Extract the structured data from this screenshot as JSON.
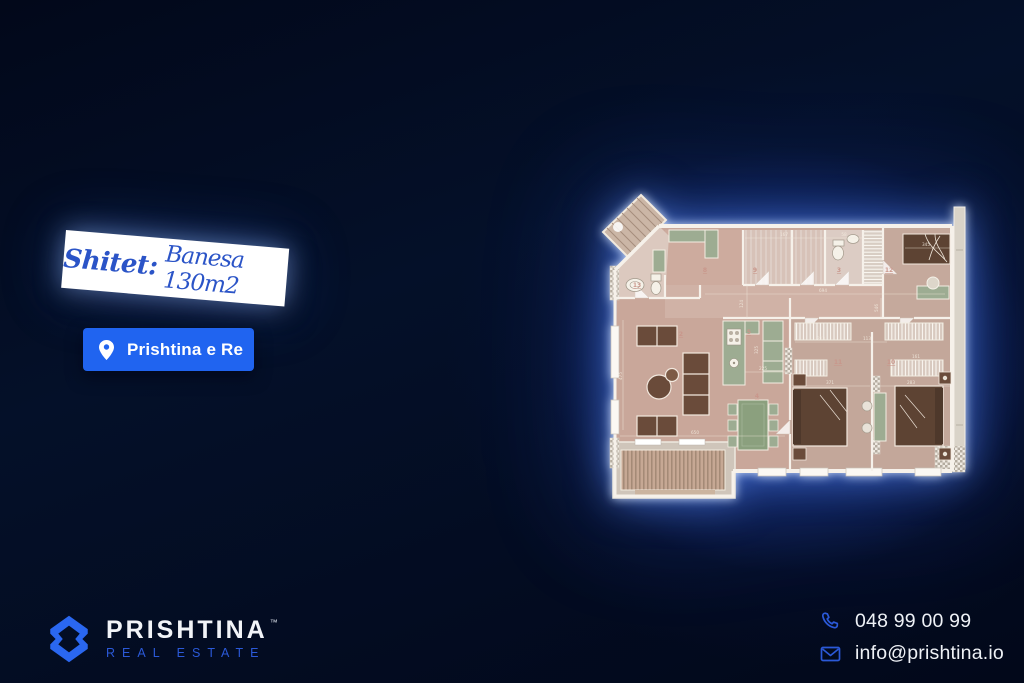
{
  "banner": {
    "prefix": "Shitet:",
    "title": "Banesa 130m2"
  },
  "location_button": {
    "label": "Prishtina e Re",
    "icon": "location-pin"
  },
  "brand": {
    "name": "PRISHTINA",
    "trademark": "™",
    "tagline": "REAL ESTATE"
  },
  "contact": {
    "phone": "048 99 00 99",
    "email": "info@prishtina.io",
    "phone_icon": "phone",
    "email_icon": "envelope"
  },
  "colors": {
    "background": "#030a1e",
    "accent_blue": "#2064f0",
    "banner_text_blue": "#2b54c7",
    "tagline_blue": "#2b59d8",
    "glow_blue": "#2d62e1",
    "floor_pink": "#c9a79a",
    "furniture_brown": "#5d4333",
    "cabinet_green": "#9dac92"
  },
  "floorplan": {
    "description": "apartment floor plan 130m2, glowing on blue backdrop",
    "room_labels": [
      {
        "text": "13",
        "x": 42,
        "y": 97
      },
      {
        "text": "8",
        "x": 110,
        "y": 82
      },
      {
        "text": "9",
        "x": 160,
        "y": 82
      },
      {
        "text": "3",
        "x": 244,
        "y": 82
      },
      {
        "text": "12",
        "x": 294,
        "y": 82
      },
      {
        "text": "2",
        "x": 86,
        "y": 146
      },
      {
        "text": "5",
        "x": 154,
        "y": 144
      },
      {
        "text": "4",
        "x": 162,
        "y": 208
      },
      {
        "text": "11",
        "x": 243,
        "y": 174
      },
      {
        "text": "10",
        "x": 296,
        "y": 174
      }
    ],
    "dimensions": [
      {
        "text": "167",
        "x": 189,
        "y": 46
      },
      {
        "text": "58",
        "x": 249,
        "y": 46
      },
      {
        "text": "345",
        "x": 331,
        "y": 56
      },
      {
        "text": "694",
        "x": 228,
        "y": 102
      },
      {
        "text": "124",
        "x": 148,
        "y": 114,
        "rot": -90
      },
      {
        "text": "213",
        "x": 226,
        "y": 150
      },
      {
        "text": "113",
        "x": 272,
        "y": 150
      },
      {
        "text": "546",
        "x": 283,
        "y": 118,
        "rot": -90
      },
      {
        "text": "161",
        "x": 321,
        "y": 168
      },
      {
        "text": "225",
        "x": 168,
        "y": 180
      },
      {
        "text": "325",
        "x": 163,
        "y": 160,
        "rot": -90
      },
      {
        "text": "371",
        "x": 235,
        "y": 194
      },
      {
        "text": "283",
        "x": 316,
        "y": 194
      },
      {
        "text": "650",
        "x": 100,
        "y": 244
      },
      {
        "text": "475",
        "x": 27,
        "y": 186,
        "rot": -90
      }
    ]
  }
}
